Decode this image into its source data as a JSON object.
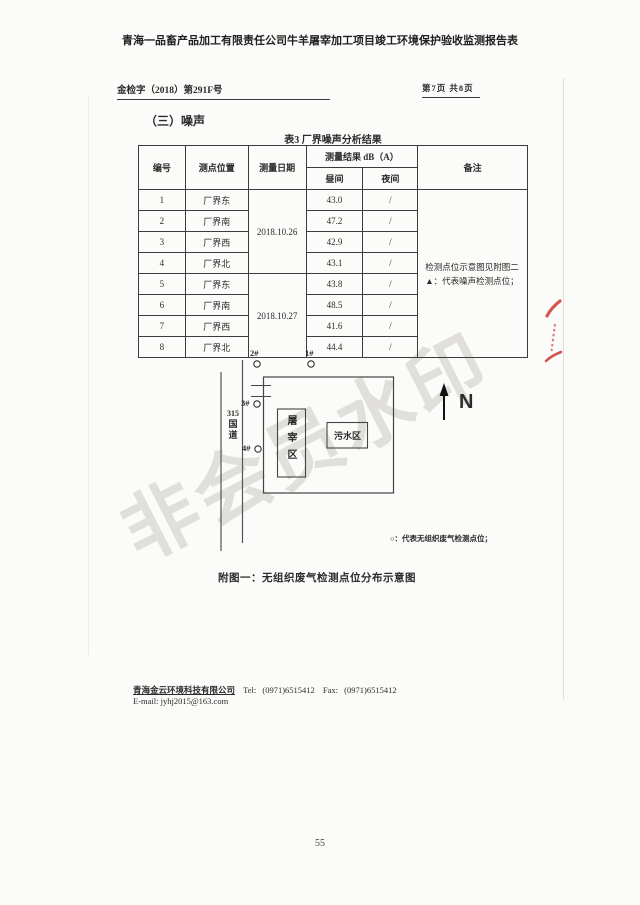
{
  "doc": {
    "title": "青海一品畜产品加工有限责任公司牛羊屠宰加工项目竣工环境保护验收监测报告表",
    "header_left": "金检字（2018）第291F号",
    "header_right": "第7页 共8页",
    "section_title": "（三）噪声",
    "page_number": "55",
    "watermark": "非会员水印"
  },
  "table": {
    "title": "表3  厂界噪声分析结果",
    "columns": {
      "no": "编号",
      "position": "测点位置",
      "date": "测量日期",
      "result": "测量结果 dB（A）",
      "day": "昼间",
      "night": "夜间",
      "remark": "备注"
    },
    "dates": [
      "2018.10.26",
      "2018.10.27"
    ],
    "rows": [
      {
        "no": "1",
        "position": "厂界东",
        "day": "43.0",
        "night": "/"
      },
      {
        "no": "2",
        "position": "厂界南",
        "day": "47.2",
        "night": "/"
      },
      {
        "no": "3",
        "position": "厂界西",
        "day": "42.9",
        "night": "/"
      },
      {
        "no": "4",
        "position": "厂界北",
        "day": "43.1",
        "night": "/"
      },
      {
        "no": "5",
        "position": "厂界东",
        "day": "43.8",
        "night": "/"
      },
      {
        "no": "6",
        "position": "厂界南",
        "day": "48.5",
        "night": "/"
      },
      {
        "no": "7",
        "position": "厂界西",
        "day": "41.6",
        "night": "/"
      },
      {
        "no": "8",
        "position": "厂界北",
        "day": "44.4",
        "night": "/"
      }
    ],
    "remark_line1": "检测点位示意图见附图二",
    "remark_line2": "▲：代表噪声检测点位；"
  },
  "diagram": {
    "point_1": "1#",
    "point_2": "2#",
    "point_3": "3#",
    "point_4": "4#",
    "road_chars": [
      "315",
      "国",
      "道"
    ],
    "slaughter_area": "屠宰区",
    "sewage_area": "污水区",
    "north": "N",
    "legend": "○：代表无组织废气检测点位；",
    "caption": "附图一：无组织废气检测点位分布示意图"
  },
  "footer": {
    "company": "青海金云环境科技有限公司",
    "tel_label": "Tel:",
    "tel": "(0971)6515412",
    "fax_label": "Fax:",
    "fax": "(0971)6515412",
    "email_line": "E-mail: jyhj2015@163.com"
  }
}
